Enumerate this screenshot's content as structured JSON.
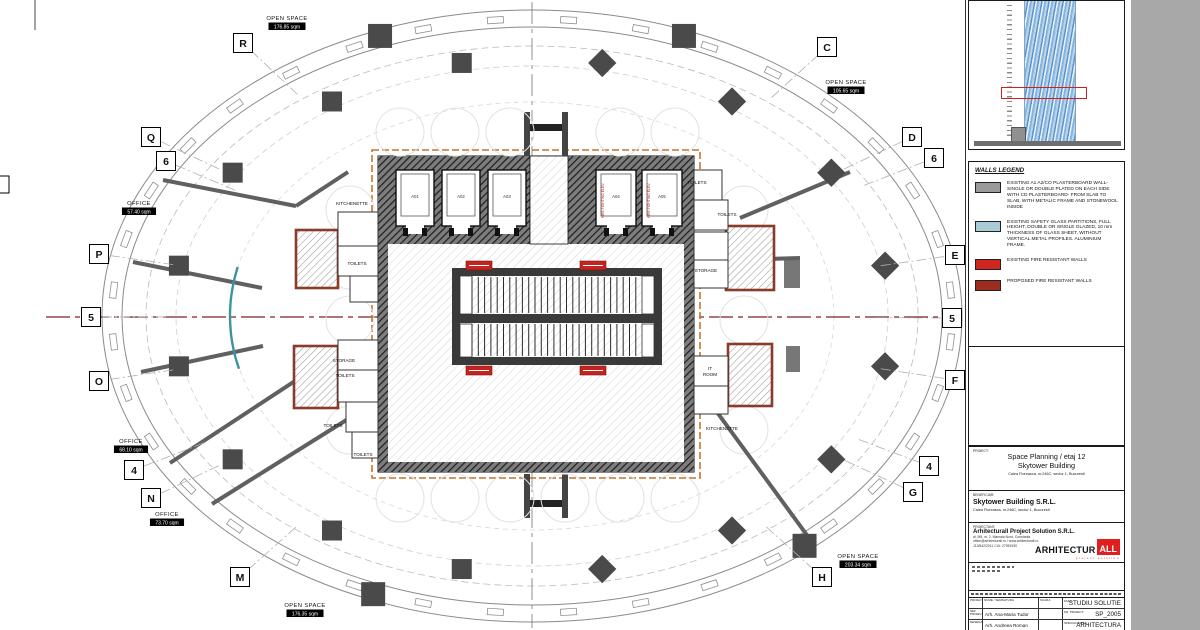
{
  "desktop": {
    "bg": "#a8a8a8",
    "paper": "#ffffff"
  },
  "plan": {
    "center": {
      "x": 532,
      "y": 316
    },
    "colors": {
      "column": "#4a4a4a",
      "wall_line": "#606060",
      "glass": "#3d93a0",
      "fire": "#c42420",
      "fire_dark": "#9e2b20",
      "boundary": "#c4742c",
      "storage_border": "#8a3c28",
      "axis_h": "#7a2020",
      "facade": "#8a8a8a"
    },
    "grid_bubbles": [
      {
        "label": "R",
        "x": 243,
        "y": 43
      },
      {
        "label": "C",
        "x": 827,
        "y": 47
      },
      {
        "label": "Q",
        "x": 151,
        "y": 137
      },
      {
        "label": "D",
        "x": 912,
        "y": 137
      },
      {
        "label": "6",
        "x": 166,
        "y": 161
      },
      {
        "label": "6",
        "x": 934,
        "y": 158
      },
      {
        "label": "P",
        "x": 99,
        "y": 254
      },
      {
        "label": "E",
        "x": 955,
        "y": 255
      },
      {
        "label": "5",
        "x": 91,
        "y": 317
      },
      {
        "label": "5",
        "x": 952,
        "y": 318
      },
      {
        "label": "O",
        "x": 99,
        "y": 381
      },
      {
        "label": "F",
        "x": 955,
        "y": 380
      },
      {
        "label": "4",
        "x": 134,
        "y": 470
      },
      {
        "label": "4",
        "x": 929,
        "y": 466
      },
      {
        "label": "N",
        "x": 151,
        "y": 498
      },
      {
        "label": "G",
        "x": 913,
        "y": 492
      },
      {
        "label": "M",
        "x": 240,
        "y": 577
      },
      {
        "label": "H",
        "x": 822,
        "y": 577
      }
    ],
    "room_labels": [
      {
        "name": "OPEN SPACE",
        "area": "176.85 sqm",
        "x": 287,
        "y": 16
      },
      {
        "name": "OPEN SPACE",
        "area": "105.65 sqm",
        "x": 846,
        "y": 80
      },
      {
        "name": "OPEN SPACE",
        "area": "203.34 sqm",
        "x": 858,
        "y": 554
      },
      {
        "name": "OPEN SPACE",
        "area": "176.35 sqm",
        "x": 305,
        "y": 603
      },
      {
        "name": "OFFICE",
        "area": "57.40 sqm",
        "x": 139,
        "y": 201
      },
      {
        "name": "OFFICE",
        "area": "68.10 sqm",
        "x": 131,
        "y": 439
      },
      {
        "name": "OFFICE",
        "area": "73.70 sqm",
        "x": 167,
        "y": 512
      }
    ],
    "small_labels": [
      {
        "text": "KITCHENETTE",
        "x": 352,
        "y": 205
      },
      {
        "text": "KITCHENETTE",
        "x": 722,
        "y": 430
      },
      {
        "text": "TOILETS",
        "x": 357,
        "y": 265
      },
      {
        "text": "TOILETS",
        "x": 345,
        "y": 377
      },
      {
        "text": "TOILETS",
        "x": 333,
        "y": 427
      },
      {
        "text": "TOILETS",
        "x": 363,
        "y": 456
      },
      {
        "text": "TOILETS",
        "x": 697,
        "y": 184
      },
      {
        "text": "TOILETS",
        "x": 727,
        "y": 216
      },
      {
        "text": "STORAGE",
        "x": 344,
        "y": 362
      },
      {
        "text": "STORAGE",
        "x": 706,
        "y": 272
      },
      {
        "text": "IT",
        "x": 710,
        "y": 370
      },
      {
        "text": "ROOM",
        "x": 710,
        "y": 376
      }
    ],
    "elevators": {
      "y": 170,
      "h": 56,
      "shafts": [
        {
          "x": 396,
          "w": 38,
          "label": "A01"
        },
        {
          "x": 442,
          "w": 38,
          "label": "A02"
        },
        {
          "x": 488,
          "w": 38,
          "label": "A03"
        },
        {
          "x": 596,
          "w": 40,
          "label": "A04",
          "fire": true
        },
        {
          "x": 642,
          "w": 40,
          "label": "A05",
          "fire": true
        }
      ],
      "fire_text": "FIRE FIGHTING ELEV."
    },
    "interior_column_angles": [
      11.25,
      33.75,
      56.25,
      78.75,
      101.25,
      123.75,
      146.25,
      168.75,
      191.25,
      213.75,
      236.25,
      258.75,
      281.25,
      303.75,
      326.25,
      348.75
    ],
    "facade_column_angles": [
      249,
      291,
      112,
      50
    ],
    "walls": [
      [
        163,
        180,
        296,
        206
      ],
      [
        296,
        206,
        348,
        172
      ],
      [
        133,
        262,
        262,
        288
      ],
      [
        141,
        372,
        263,
        346
      ],
      [
        170,
        463,
        330,
        358
      ],
      [
        212,
        504,
        372,
        404
      ],
      [
        740,
        218,
        850,
        172
      ],
      [
        736,
        260,
        800,
        258
      ],
      [
        703,
        393,
        812,
        542
      ]
    ],
    "glass_arcs": [
      {
        "rx": 302,
        "ry": 218,
        "t1": 166,
        "t2": 193
      }
    ],
    "fire_badges": [
      [
        466,
        261
      ],
      [
        580,
        261
      ],
      [
        466,
        366
      ],
      [
        580,
        366
      ]
    ],
    "storage_rooms": [
      [
        296,
        230,
        42,
        58
      ],
      [
        294,
        346,
        44,
        62
      ],
      [
        726,
        226,
        48,
        64
      ],
      [
        728,
        344,
        44,
        62
      ]
    ],
    "side_rooms": [
      [
        338,
        212,
        40,
        34
      ],
      [
        338,
        246,
        40,
        30
      ],
      [
        350,
        276,
        28,
        26
      ],
      [
        338,
        340,
        40,
        30
      ],
      [
        338,
        370,
        40,
        32
      ],
      [
        346,
        402,
        32,
        30
      ],
      [
        352,
        432,
        26,
        26
      ],
      [
        694,
        170,
        28,
        30
      ],
      [
        694,
        200,
        34,
        30
      ],
      [
        694,
        232,
        34,
        28
      ],
      [
        694,
        260,
        34,
        28
      ],
      [
        694,
        356,
        34,
        30
      ],
      [
        694,
        386,
        34,
        28
      ]
    ]
  },
  "sidebar": {
    "legend": {
      "title": "WALLS LEGEND",
      "items": [
        {
          "color": "#9a9a9a",
          "text": "EXISTING A1 A2/CO PLASTERBOARD WALL- SINGLE OR DOUBLE PLATED ON EACH SIDE WITH CD PLASTERBOARD- FROM SLAB TO SLAB, WITH METALIC FRAME AND STONEWOOL INSIDE"
        },
        {
          "color": "#a9ccd6",
          "text": "EXISTING SAFETY GLASS PARTITIONS, FULL HEIGHT, DOUBLE OR SINGLE GLAZED, 10 mm THICKNESS OF GLASS SHEET, WITHOUT VERTICAL METAL PROFILES. ALUMINIUM FRAME."
        },
        {
          "color": "#d02620",
          "text": "EXISTING FIRE RESISTANT WALLS"
        },
        {
          "color": "#9e2b20",
          "text": "PROPOSED FIRE RESISTANT WALLS"
        }
      ]
    },
    "titleblock": {
      "project_label": "PROIECT:",
      "project_title1": "Space Planning / etaj 12",
      "project_title2": "Skytower Building",
      "project_address": "Calea Floreasca, nr.246C, sector 1, Bucuresti",
      "client_label": "BENEFICIAR:",
      "client_name": "Skytower Building S.R.L.",
      "client_address": "Calea Floreasca, nr.246C, sector 1, Bucuresti",
      "designer_label": "PROIECTANT:",
      "designer_name": "Arhitecturall Project Solution S.R.L.",
      "designer_address": "al. M5, nr. 2, Mamaia Nord, Constanta",
      "designer_contact": "office@arhitecturall.ro / www.arhitecturall.ro",
      "designer_reg": "J13/542/2011   CUI: 27951930",
      "logo_black": "ARHITECTUR",
      "logo_red": "ALL",
      "logo_sub": "project solution",
      "table": {
        "col1_header": "PROIECTANT",
        "col2_header": "NUME / SEMNATURA",
        "scale_label": "SCARA:",
        "phase_label": "FAZA:",
        "phase_value": "STUDIU SOLUTIE",
        "row2_role": "SEF PROIECT",
        "row2_name": "Arh. Ana-Maria Tudor",
        "project_no_label": "NR. PROIECT:",
        "project_no_value": "SP_2005",
        "row3_role": "DESENAT",
        "row3_name": "Arh. Andreea Roman",
        "specialty_label": "SPECIALITATEA:",
        "specialty_value": "ARHITECTURA"
      }
    }
  }
}
